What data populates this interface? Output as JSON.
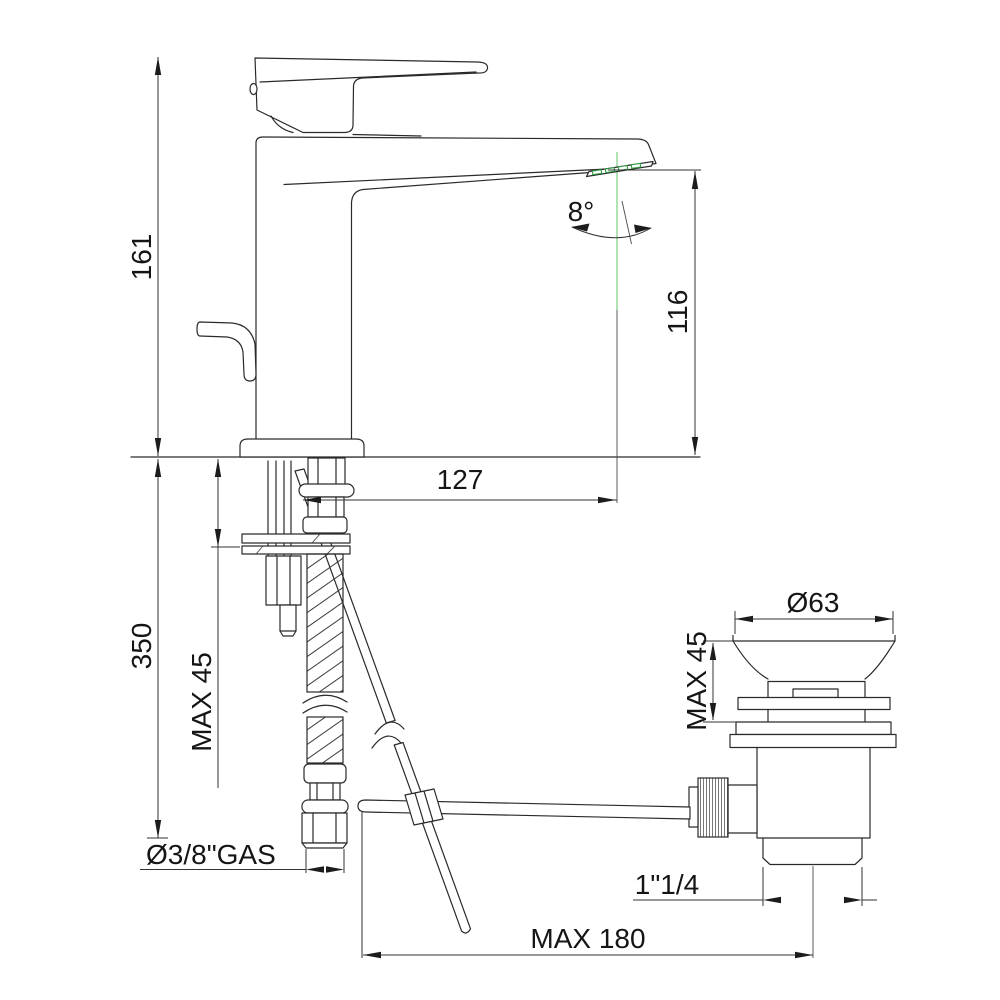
{
  "drawing": {
    "title": "Single-lever basin mixer with pop-up waste — dimensional technical drawing",
    "units": "mm",
    "colors": {
      "line": "#2a2a2a",
      "dimension": "#333333",
      "accent_green": "#2f9e44",
      "centerline_green": "#8fd694",
      "knurl_gray": "#777777",
      "background": "#ffffff"
    },
    "labels": {
      "total_height": "161",
      "below_deck_length": "350",
      "max_mounting_thickness": "MAX 45",
      "supply_thread": "Ø3/8\"GAS",
      "spout_reach": "127",
      "spout_height": "116",
      "spout_angle": "8°",
      "waste_flange_diameter": "Ø63",
      "waste_max_thickness": "MAX 45",
      "waste_thread": "1\"1/4",
      "rod_max_reach": "MAX 180"
    }
  }
}
